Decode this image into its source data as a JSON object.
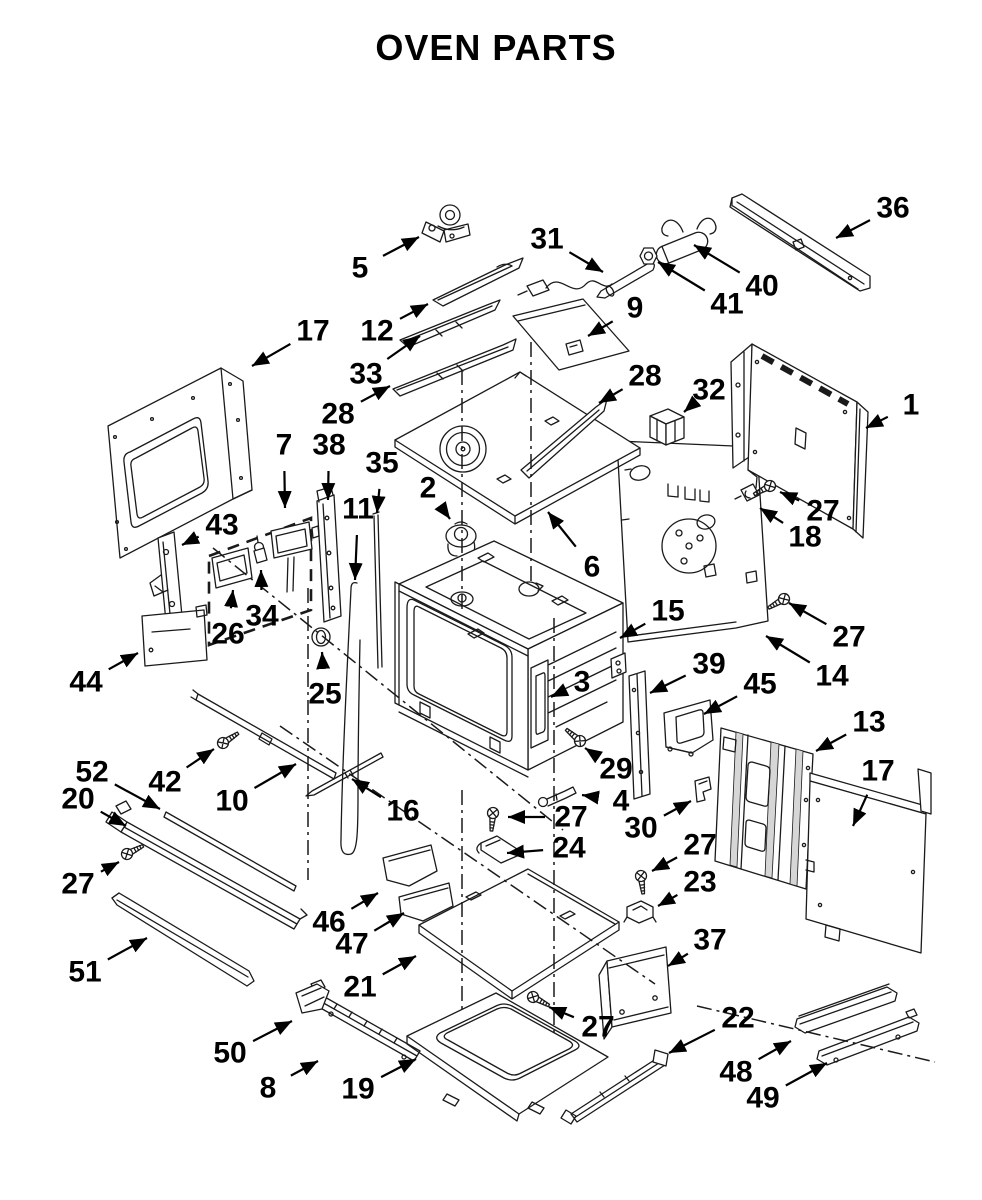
{
  "title": "OVEN PARTS",
  "canvas": {
    "width": 982,
    "height": 1200,
    "background": "#ffffff",
    "line_color": "#1a1a1a",
    "label_color": "#000000"
  },
  "callouts": [
    {
      "n": "5",
      "x": 360,
      "y": 268,
      "tx": 419,
      "ty": 237
    },
    {
      "n": "12",
      "x": 377,
      "y": 331,
      "tx": 428,
      "ty": 304
    },
    {
      "n": "33",
      "x": 366,
      "y": 374,
      "tx": 420,
      "ty": 336
    },
    {
      "n": "31",
      "x": 547,
      "y": 239,
      "tx": 603,
      "ty": 272
    },
    {
      "n": "9",
      "x": 635,
      "y": 308,
      "tx": 588,
      "ty": 336
    },
    {
      "n": "40",
      "x": 762,
      "y": 286,
      "tx": 694,
      "ty": 245
    },
    {
      "n": "41",
      "x": 727,
      "y": 304,
      "tx": 658,
      "ty": 262
    },
    {
      "n": "36",
      "x": 893,
      "y": 208,
      "tx": 836,
      "ty": 238
    },
    {
      "n": "17",
      "x": 313,
      "y": 331,
      "tx": 252,
      "ty": 366
    },
    {
      "n": "28",
      "x": 338,
      "y": 414,
      "tx": 390,
      "ty": 386
    },
    {
      "n": "28",
      "x": 645,
      "y": 376,
      "tx": 599,
      "ty": 403
    },
    {
      "n": "32",
      "x": 709,
      "y": 390,
      "tx": 684,
      "ty": 412
    },
    {
      "n": "1",
      "x": 911,
      "y": 405,
      "tx": 866,
      "ty": 428
    },
    {
      "n": "27",
      "x": 823,
      "y": 511,
      "tx": 780,
      "ty": 492
    },
    {
      "n": "18",
      "x": 805,
      "y": 537,
      "tx": 760,
      "ty": 508
    },
    {
      "n": "7",
      "x": 284,
      "y": 445,
      "tx": 285,
      "ty": 508
    },
    {
      "n": "38",
      "x": 329,
      "y": 445,
      "tx": 328,
      "ty": 500
    },
    {
      "n": "35",
      "x": 382,
      "y": 463,
      "tx": 377,
      "ty": 513
    },
    {
      "n": "11",
      "x": 358,
      "y": 509,
      "tx": 355,
      "ty": 580
    },
    {
      "n": "2",
      "x": 428,
      "y": 488,
      "tx": 450,
      "ty": 519
    },
    {
      "n": "43",
      "x": 222,
      "y": 525,
      "tx": 182,
      "ty": 545
    },
    {
      "n": "34",
      "x": 262,
      "y": 616,
      "tx": 261,
      "ty": 570
    },
    {
      "n": "26",
      "x": 228,
      "y": 634,
      "tx": 233,
      "ty": 590
    },
    {
      "n": "44",
      "x": 86,
      "y": 682,
      "tx": 138,
      "ty": 653
    },
    {
      "n": "25",
      "x": 325,
      "y": 694,
      "tx": 322,
      "ty": 652
    },
    {
      "n": "6",
      "x": 592,
      "y": 567,
      "tx": 548,
      "ty": 512
    },
    {
      "n": "15",
      "x": 668,
      "y": 611,
      "tx": 620,
      "ty": 638
    },
    {
      "n": "3",
      "x": 582,
      "y": 682,
      "tx": 551,
      "ty": 697
    },
    {
      "n": "29",
      "x": 616,
      "y": 769,
      "tx": 585,
      "ty": 748
    },
    {
      "n": "39",
      "x": 709,
      "y": 664,
      "tx": 650,
      "ty": 693
    },
    {
      "n": "45",
      "x": 760,
      "y": 684,
      "tx": 704,
      "ty": 714
    },
    {
      "n": "13",
      "x": 869,
      "y": 722,
      "tx": 816,
      "ty": 751
    },
    {
      "n": "17",
      "x": 878,
      "y": 771,
      "tx": 853,
      "ty": 826
    },
    {
      "n": "14",
      "x": 832,
      "y": 676,
      "tx": 766,
      "ty": 636
    },
    {
      "n": "27",
      "x": 849,
      "y": 637,
      "tx": 789,
      "ty": 603
    },
    {
      "n": "4",
      "x": 621,
      "y": 801,
      "tx": 582,
      "ty": 795
    },
    {
      "n": "30",
      "x": 641,
      "y": 828,
      "tx": 691,
      "ty": 801
    },
    {
      "n": "52",
      "x": 92,
      "y": 772,
      "tx": 160,
      "ty": 809
    },
    {
      "n": "20",
      "x": 78,
      "y": 799,
      "tx": 126,
      "ty": 826
    },
    {
      "n": "42",
      "x": 165,
      "y": 782,
      "tx": 214,
      "ty": 749
    },
    {
      "n": "10",
      "x": 232,
      "y": 801,
      "tx": 296,
      "ty": 764
    },
    {
      "n": "16",
      "x": 403,
      "y": 811,
      "tx": 352,
      "ty": 779
    },
    {
      "n": "27",
      "x": 78,
      "y": 884,
      "tx": 119,
      "ty": 862
    },
    {
      "n": "51",
      "x": 85,
      "y": 972,
      "tx": 147,
      "ty": 938
    },
    {
      "n": "46",
      "x": 329,
      "y": 922,
      "tx": 378,
      "ty": 893
    },
    {
      "n": "47",
      "x": 352,
      "y": 944,
      "tx": 404,
      "ty": 913
    },
    {
      "n": "21",
      "x": 360,
      "y": 987,
      "tx": 416,
      "ty": 956
    },
    {
      "n": "27",
      "x": 571,
      "y": 817,
      "tx": 508,
      "ty": 817
    },
    {
      "n": "24",
      "x": 569,
      "y": 848,
      "tx": 507,
      "ty": 853
    },
    {
      "n": "27",
      "x": 598,
      "y": 1027,
      "tx": 549,
      "ty": 1007
    },
    {
      "n": "23",
      "x": 700,
      "y": 882,
      "tx": 658,
      "ty": 906
    },
    {
      "n": "27",
      "x": 700,
      "y": 845,
      "tx": 652,
      "ty": 871
    },
    {
      "n": "37",
      "x": 710,
      "y": 940,
      "tx": 668,
      "ty": 966
    },
    {
      "n": "19",
      "x": 358,
      "y": 1089,
      "tx": 416,
      "ty": 1059
    },
    {
      "n": "8",
      "x": 268,
      "y": 1088,
      "tx": 318,
      "ty": 1061
    },
    {
      "n": "50",
      "x": 230,
      "y": 1053,
      "tx": 292,
      "ty": 1021
    },
    {
      "n": "22",
      "x": 738,
      "y": 1018,
      "tx": 669,
      "ty": 1053
    },
    {
      "n": "48",
      "x": 736,
      "y": 1072,
      "tx": 791,
      "ty": 1041
    },
    {
      "n": "49",
      "x": 763,
      "y": 1098,
      "tx": 827,
      "ty": 1063
    }
  ]
}
